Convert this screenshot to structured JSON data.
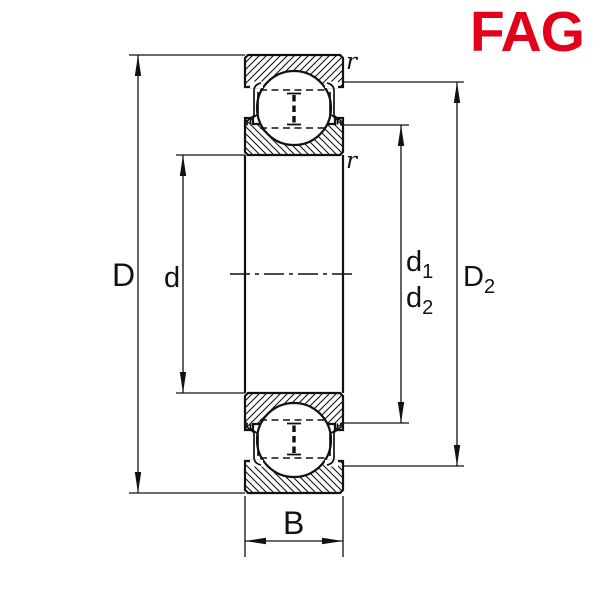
{
  "logo": {
    "text": "FAG",
    "color": "#E2001A"
  },
  "labels": {
    "outer_diameter": "D",
    "bore_diameter": "d",
    "d1": {
      "base": "d",
      "sub": "1"
    },
    "d2": {
      "base": "d",
      "sub": "2"
    },
    "D2": {
      "base": "D",
      "sub": "2"
    },
    "width": "B",
    "r_top": "r",
    "r_bottom": "r"
  },
  "colors": {
    "line": "#111111",
    "background": "#ffffff",
    "logo_red": "#E2001A"
  }
}
